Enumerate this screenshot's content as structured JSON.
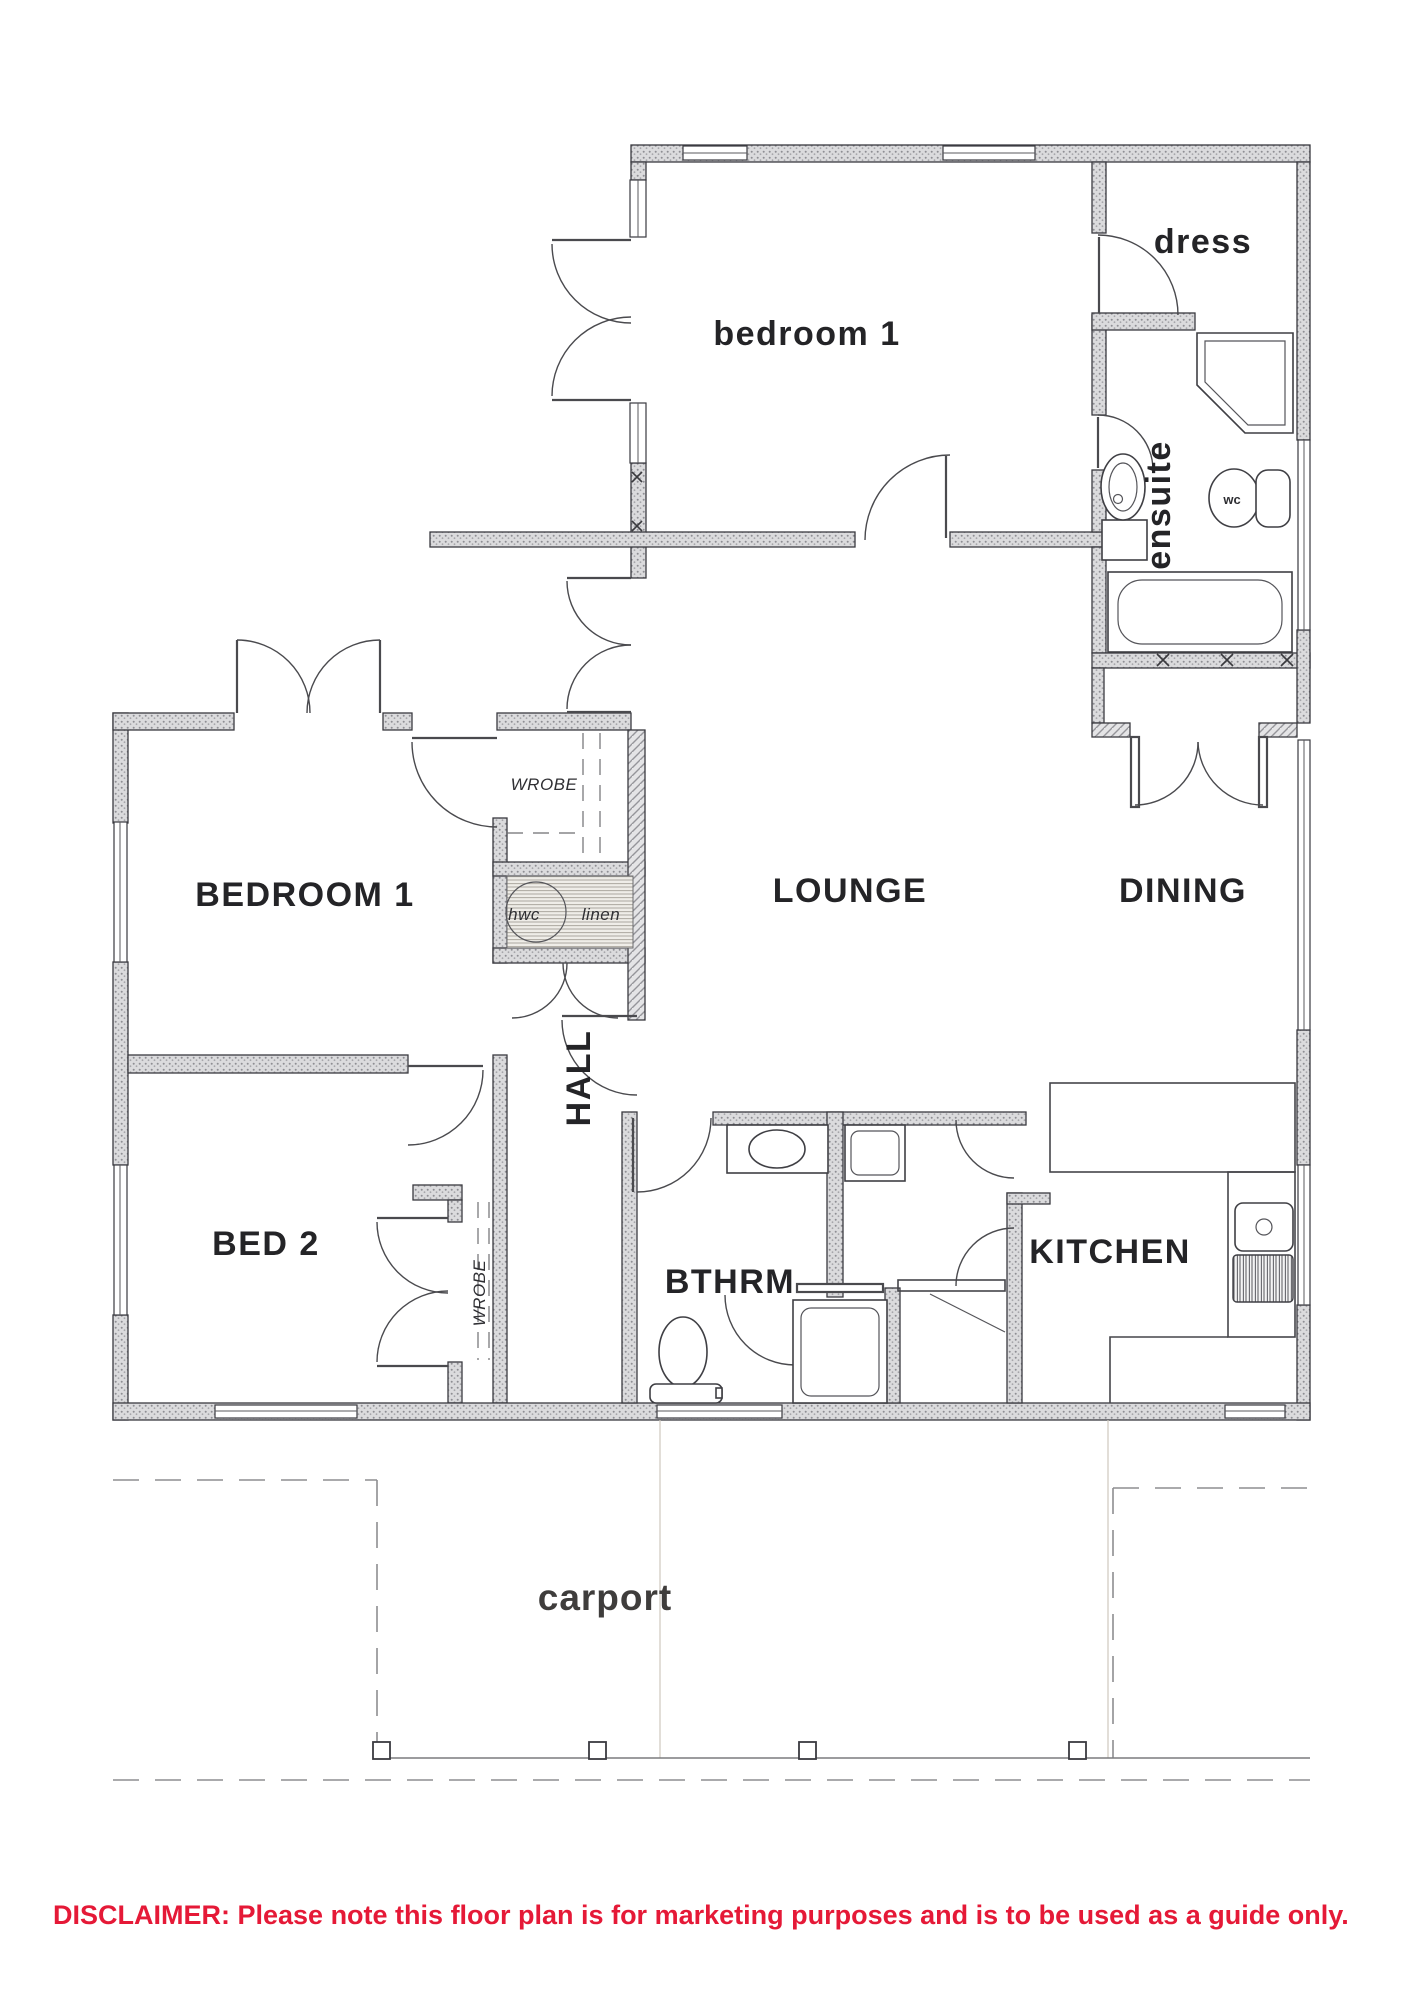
{
  "floor_plan": {
    "labels": {
      "bedroom1_upper": "bedroom 1",
      "dress": "dress",
      "ensuite": "ensuite",
      "wc": "wc",
      "bedroom1_main": "BEDROOM 1",
      "wrobe_hall": "WROBE",
      "hwc": "hwc",
      "linen": "linen",
      "lounge": "LOUNGE",
      "dining": "DINING",
      "hall": "HALL",
      "bed2": "BED 2",
      "wrobe_bed2": "WROBE",
      "bathroom": "BTHRM",
      "kitchen": "KITCHEN",
      "carport": "carport"
    },
    "disclaimer": "DISCLAIMER: Please note this floor plan is for marketing purposes and is to be used as a guide only.",
    "colors": {
      "disclaimer_red": "#e51937",
      "wall_outline": "#3a3a40",
      "wall_fill": "#d9d9db",
      "paper": "#ffffff"
    }
  }
}
